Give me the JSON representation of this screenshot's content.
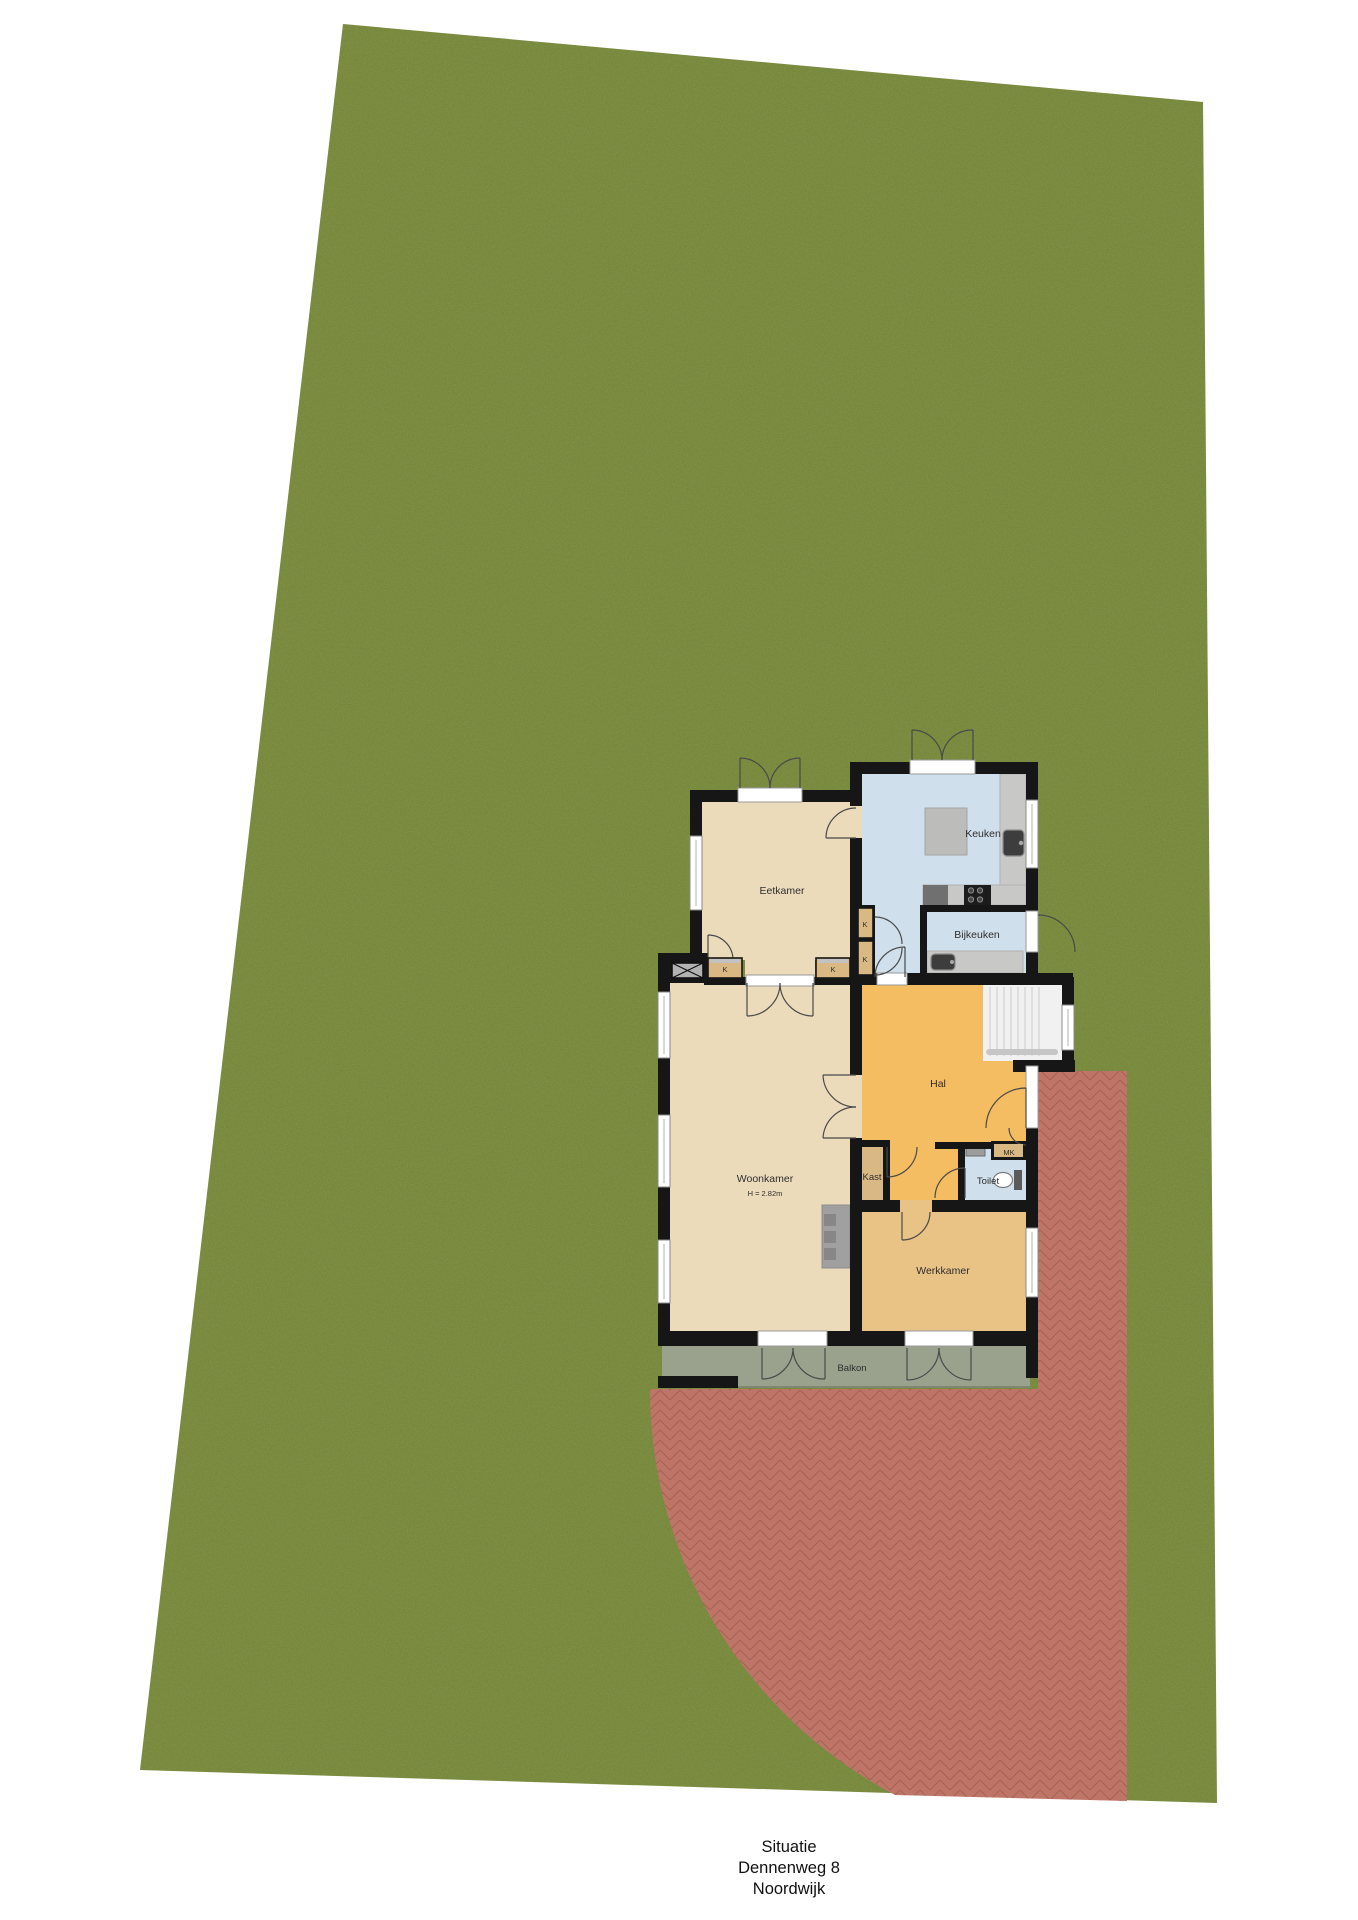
{
  "plan": {
    "type": "situation-floor-plan",
    "rooms": {
      "eetkamer": "Eetkamer",
      "keuken": "Keuken",
      "bijkeuken": "Bijkeuken",
      "hal": "Hal",
      "woonkamer": "Woonkamer",
      "woonkamer_height": "H = 2.82m",
      "kast": "Kast",
      "toilet": "Toilet",
      "mk": "MK",
      "werkkamer": "Werkkamer",
      "balkon": "Balkon",
      "closet": "K"
    }
  },
  "caption": {
    "line1": "Situatie",
    "line2": "Dennenweg 8",
    "line3": "Noordwijk"
  },
  "colors": {
    "grass": "#7d9044",
    "terrace": "#bf7466",
    "terrace_line": "#a15a4d",
    "wall": "#161616",
    "floor_tan": "#ecdbbb",
    "floor_blue": "#cfdfeb",
    "floor_hal": "#f4bd62",
    "floor_werkkamer": "#e9c286",
    "floor_closet": "#d9b884",
    "balkon": "#9aa28d",
    "counter": "#c8c8c6",
    "stairs": "#f1f1f1",
    "window_frame": "#8a8a8a"
  }
}
